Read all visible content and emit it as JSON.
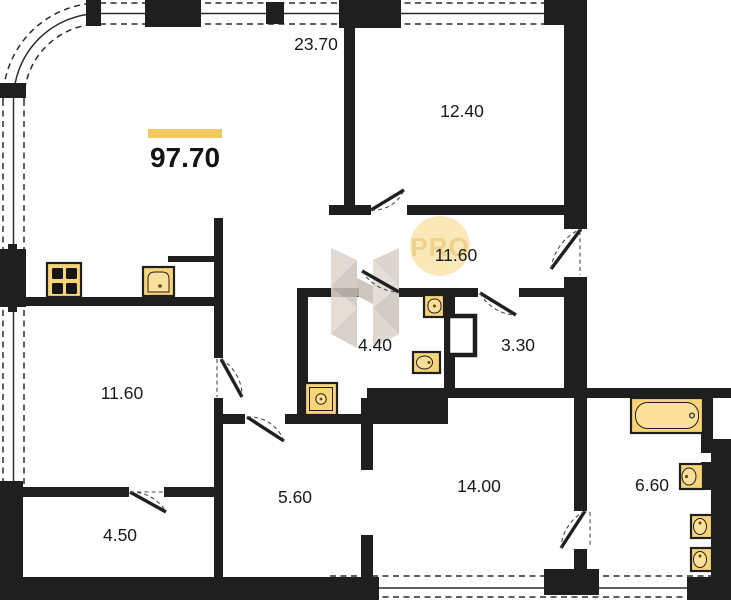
{
  "title": {
    "total_area": "97.70"
  },
  "rooms": {
    "living_kitchen": "23.70",
    "bedroom_top": "12.40",
    "hallway": "11.60",
    "bathroom": "4.40",
    "wc": "3.30",
    "bedroom_left": "11.60",
    "hall_small": "5.60",
    "storage": "4.50",
    "bedroom_bottom": "14.00",
    "bathroom_ensuite": "6.60"
  },
  "watermark": {
    "badge": "PRO"
  },
  "colors": {
    "wall": "#1f1f1f",
    "fixture_fill": "#f8d478",
    "accent_bar": "#f3c860",
    "badge_fill": "#fbe7b3",
    "badge_text": "#ecd28d",
    "logo_gray_light": "#e0d9d1",
    "logo_gray_dark": "#ccc4bb"
  },
  "fixtures": {
    "kitchen": [
      "stove-icon",
      "kitchen-sink-icon"
    ],
    "bathroom_4_40": [
      "toilet-icon",
      "washbasin-icon",
      "washing-machine-icon"
    ],
    "wc_3_30": [
      "duct-shaft-icon"
    ],
    "bathroom_6_60": [
      "bathtub-icon",
      "washbasin-icon",
      "toilet-icon",
      "toilet-icon"
    ]
  }
}
